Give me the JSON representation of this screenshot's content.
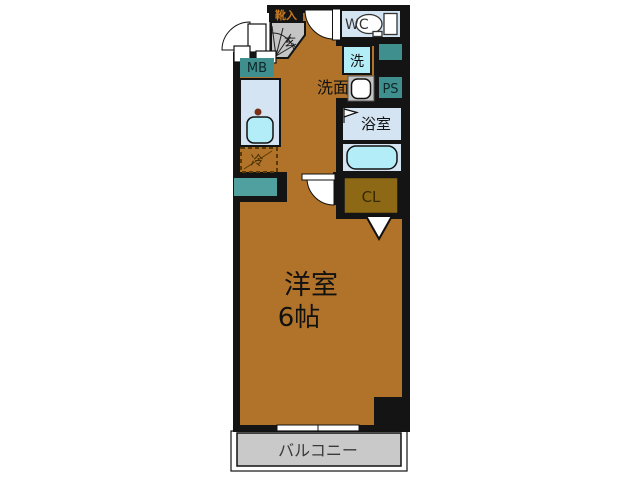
{
  "labels": {
    "shoe_cabinet": "靴入",
    "entrance": "玄",
    "meter_box": "MB",
    "toilet": "WC",
    "washer": "洗",
    "washroom": "洗面",
    "pipe_space": "PS",
    "bathroom": "浴室",
    "refrigerator": "冷",
    "closet": "CL",
    "main_room_name": "洋室",
    "main_room_size": "6帖",
    "balcony": "バルコニー"
  },
  "colors": {
    "wall": "#141414",
    "room_floor": "#b07329",
    "entrance_gray": "#c5c5c5",
    "balcony_gray": "#c9c9c9",
    "fixture_blue": "#d5e4f2",
    "water_cyan": "#b3edf8",
    "utility_teal": "#3f8f8f",
    "counter_teal": "#50a0a0",
    "closet_brown": "#8e6915",
    "shoe_label_orange": "#c8791e",
    "label_dark": "#1e1e1e",
    "balcony_text": "#3a3a3a"
  }
}
